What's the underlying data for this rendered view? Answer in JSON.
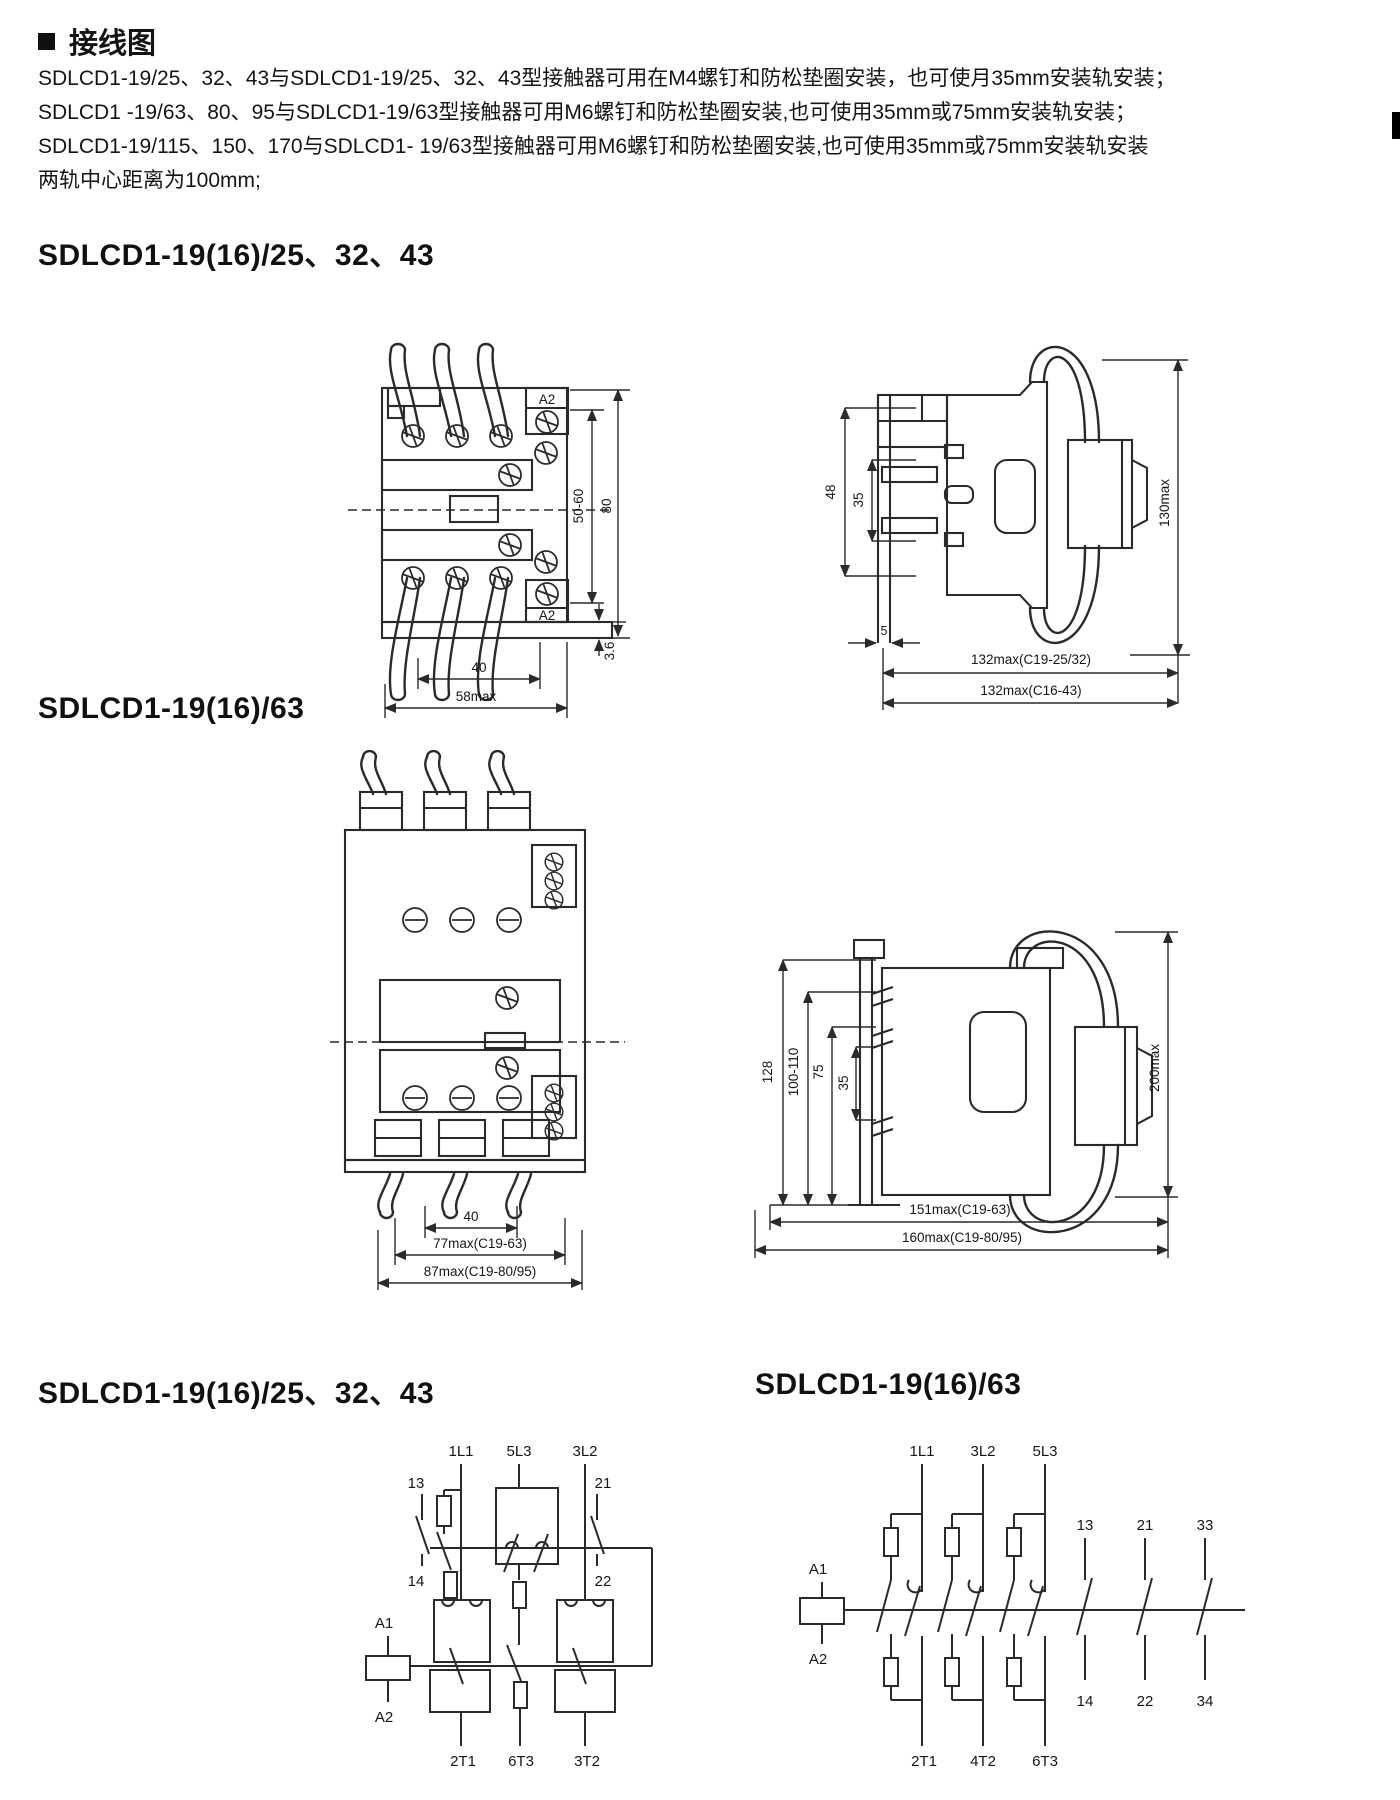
{
  "page": {
    "title": "接线图"
  },
  "intro": {
    "lines": [
      "SDLCD1-19/25、32、43与SDLCD1-19/25、32、43型接触器可用在M4螺钉和防松垫圈安装，也可使月35mm安装轨安装；",
      "SDLCD1 -19/63、80、95与SDLCD1-19/63型接触器可用M6螺钉和防松垫圈安装,也可使用35mm或75mm安装轨安装；",
      "SDLCD1-19/115、150、170与SDLCD1- 19/63型接触器可用M6螺钉和防松垫圈安装,也可使用35mm或75mm安装轨安装",
      "两轨中心距离为100mm;"
    ]
  },
  "sections": {
    "s1": "SDLCD1-19(16)/25、32、43",
    "s2": "SDLCD1-19(16)/63",
    "s3": "SDLCD1-19(16)/25、32、43",
    "s4": "SDLCD1-19(16)/63"
  },
  "front1": {
    "a2_top": "A2",
    "a2_bottom": "A2",
    "dim_5060": "50-60",
    "dim_80": "80",
    "dim_36": "3.6",
    "dim_40": "40",
    "dim_58": "58max"
  },
  "side1": {
    "dim_48": "48",
    "dim_35": "35",
    "dim_5": "5",
    "dim_130": "130max",
    "dim_132a": "132max(C19-25/32)",
    "dim_132b": "132max(C16-43)"
  },
  "front2": {
    "dim_40": "40",
    "dim_77": "77max(C19-63)",
    "dim_87": "87max(C19-80/95)"
  },
  "side2": {
    "dim_128": "128",
    "dim_100110": "100-110",
    "dim_75": "75",
    "dim_35": "35",
    "dim_200": "200max",
    "dim_151": "151max(C19-63)",
    "dim_160": "160max(C19-80/95)"
  },
  "circuit1": {
    "top": [
      "1L1",
      "5L3",
      "3L2"
    ],
    "aux1_top": "13",
    "aux1_bottom": "14",
    "aux2_top": "21",
    "aux2_bottom": "22",
    "coil_a1": "A1",
    "coil_a2": "A2",
    "bottom": [
      "2T1",
      "6T3",
      "3T2"
    ]
  },
  "circuit2": {
    "top": [
      "1L1",
      "3L2",
      "5L3"
    ],
    "aux_top": [
      "13",
      "21",
      "33"
    ],
    "aux_bottom": [
      "14",
      "22",
      "34"
    ],
    "coil_a1": "A1",
    "coil_a2": "A2",
    "bottom": [
      "2T1",
      "4T2",
      "6T3"
    ]
  }
}
